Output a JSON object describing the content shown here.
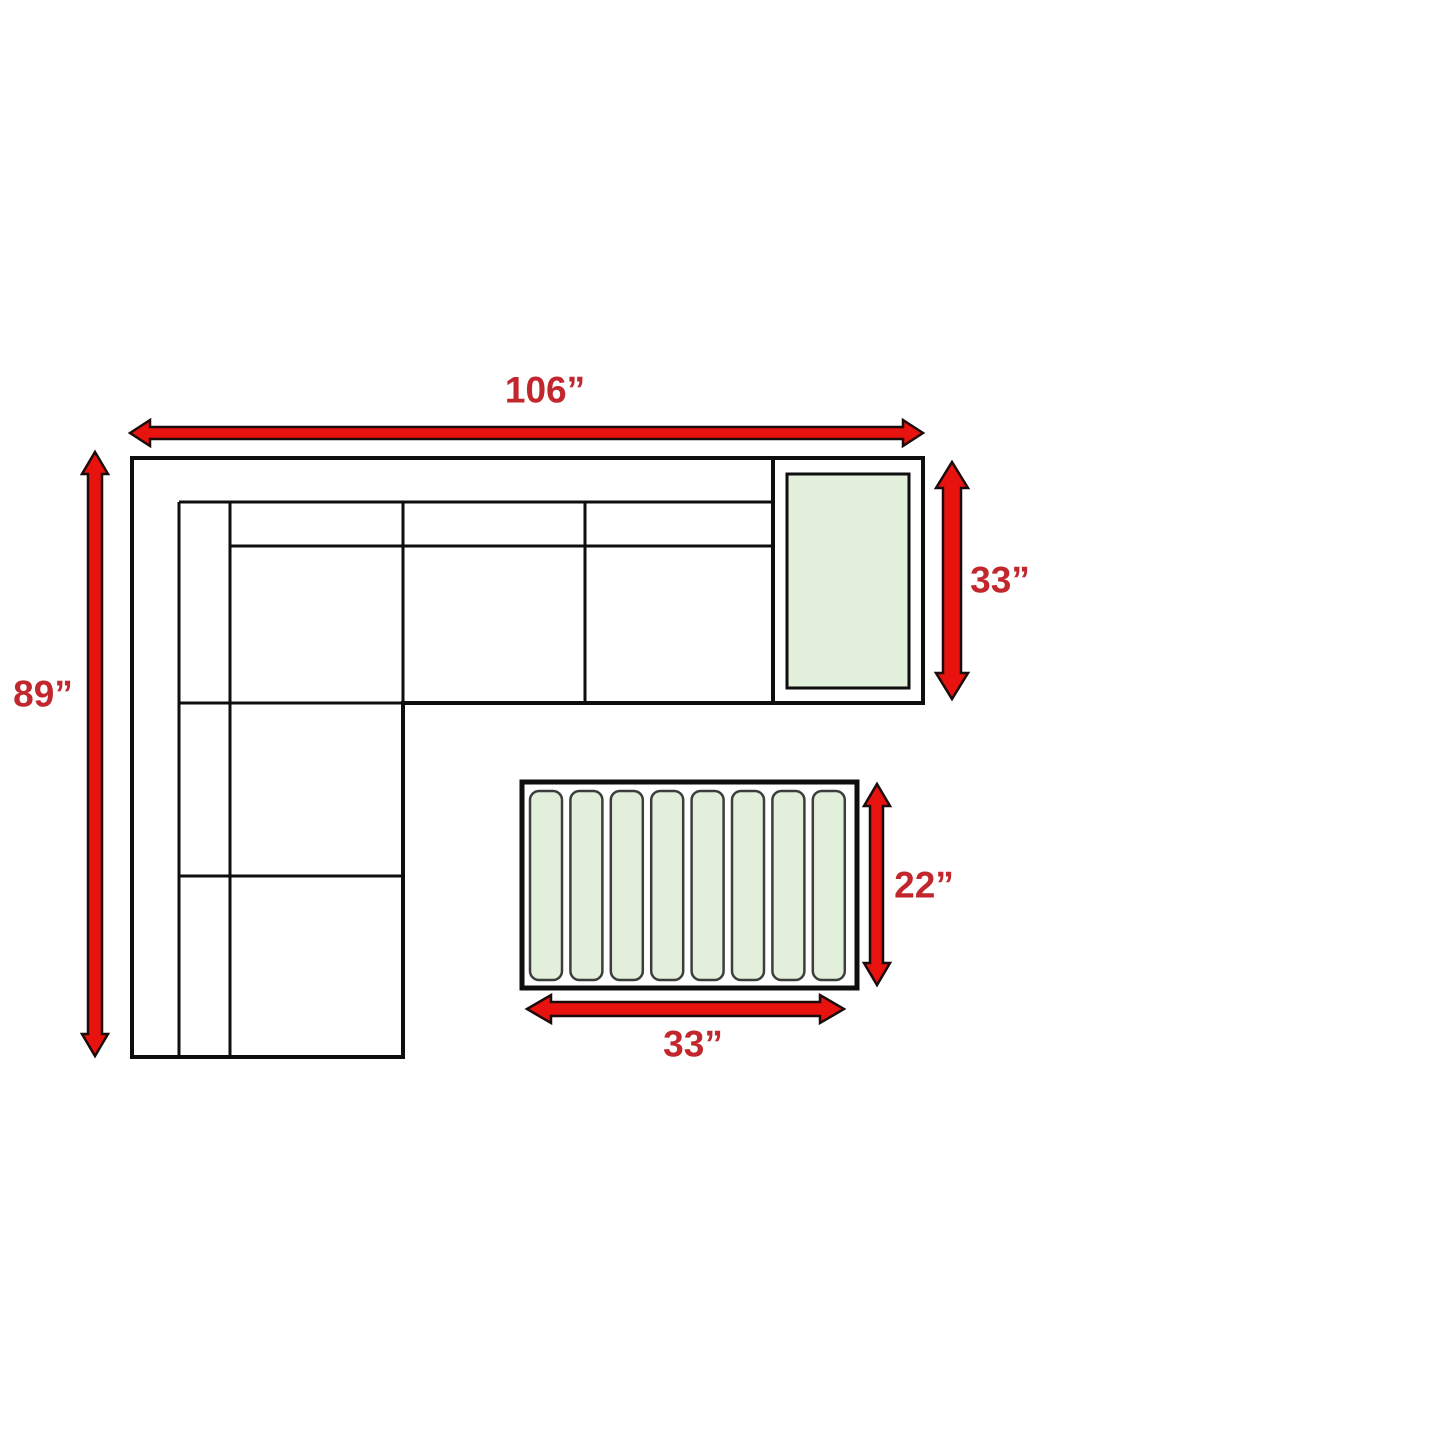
{
  "diagram": {
    "type": "furniture-dimension-diagram",
    "title": "Sectional sofa with corner end table and slatted coffee table — top view with dimensions",
    "dimensions": {
      "sofa_width": "106”",
      "sofa_depth": "89”",
      "end_table_side": "33”",
      "coffee_table_depth": "22”",
      "coffee_table_width": "33”"
    },
    "coffee_table": {
      "slat_count": 8
    },
    "colors": {
      "arrow_red": "#e8120e",
      "arrow_outline": "#1c0b0b",
      "label_red": "#c1272d",
      "line_black": "#0e0e0e",
      "table_green": "#e2efda",
      "slat_outline": "#3d3d3d"
    }
  }
}
